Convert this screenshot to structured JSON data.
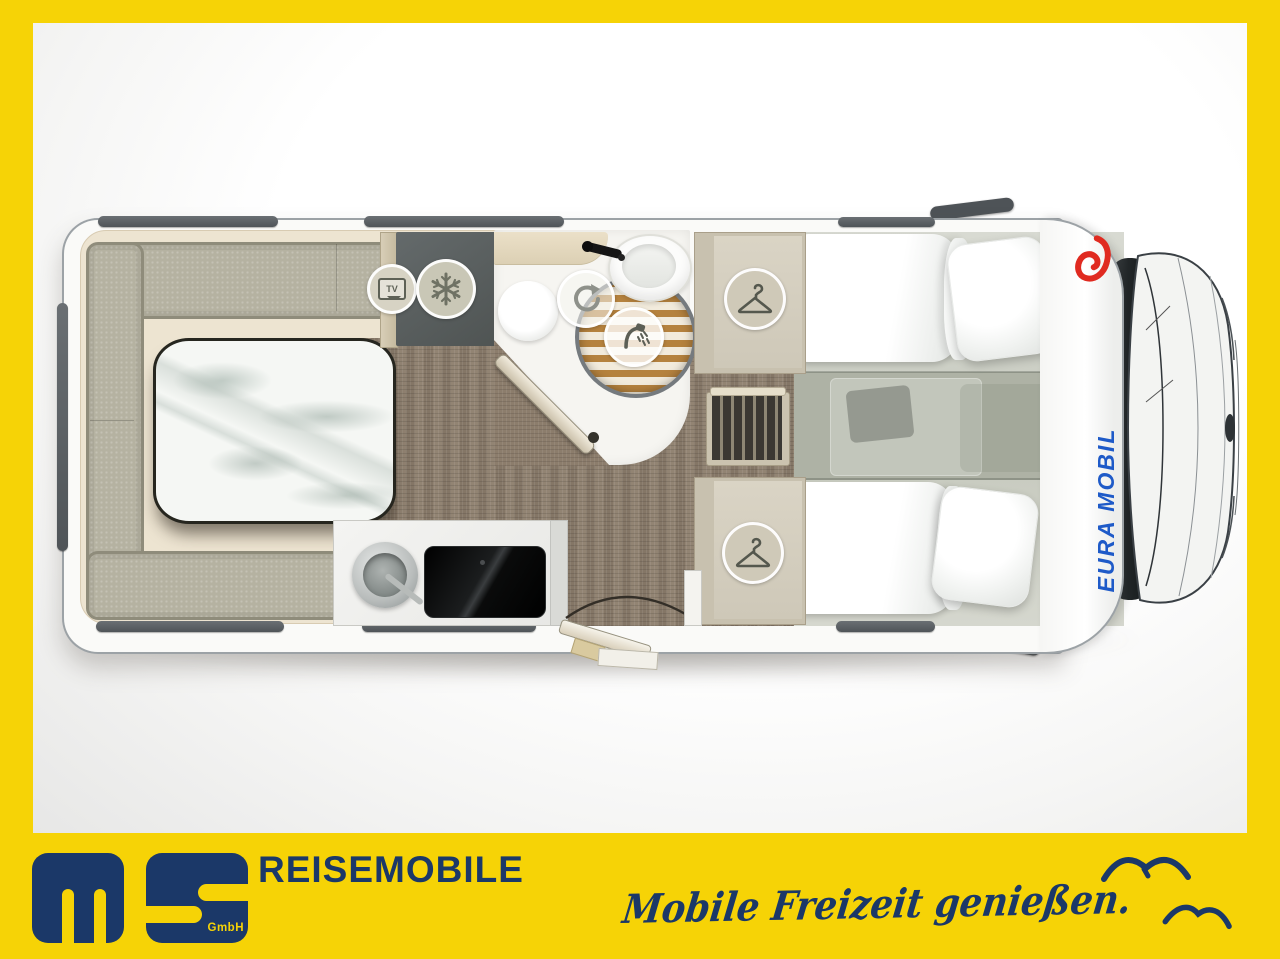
{
  "page": {
    "background_yellow": "#F6D306",
    "canvas_white": "#FFFFFF"
  },
  "branding_bar": {
    "logo": {
      "monogram": "ms",
      "suffix": "GmbH",
      "color_navy": "#1B3868"
    },
    "wordmark": "REISEMOBILE",
    "tagline": "Mobile Freizeit genießen.",
    "birds": [
      {
        "name": "seagull-icon"
      },
      {
        "name": "seagull-icon"
      }
    ]
  },
  "floorplan": {
    "vehicle": {
      "view": "motorhome-top-view-floorplan",
      "brand_side_text": "EURA MOBIL",
      "brand_text_color": "#1E5AC8",
      "brand_logo": "eura-mobil-swirl-icon",
      "brand_logo_color": "#E02A20"
    },
    "tv_label": "TV",
    "feature_icons": [
      {
        "name": "tv-icon",
        "meaning": "tv-mount"
      },
      {
        "name": "snowflake-icon",
        "meaning": "refrigerator"
      },
      {
        "name": "rotate-icon",
        "meaning": "swivel-toilet"
      },
      {
        "name": "shower-icon",
        "meaning": "shower"
      },
      {
        "name": "hanger-icon",
        "meaning": "wardrobe-top"
      },
      {
        "name": "hanger-icon",
        "meaning": "wardrobe-bottom"
      }
    ],
    "areas": [
      "rear-u-lounge",
      "marble-table",
      "tv-cabinet",
      "refrigerator",
      "bathroom",
      "shower",
      "wardrobe-top",
      "bed-steps",
      "wardrobe-bottom",
      "kitchen",
      "entry-door",
      "twin-single-beds",
      "cab"
    ]
  }
}
